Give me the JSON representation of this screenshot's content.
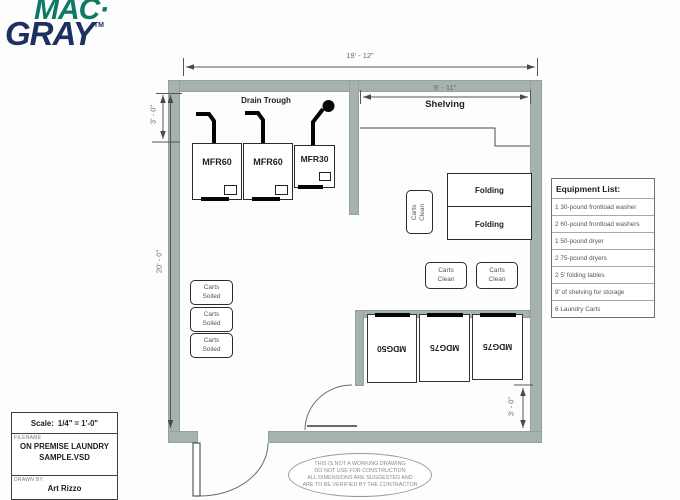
{
  "logo": {
    "mac": "MAC·",
    "gray": "GRAY",
    "trademark": "TM"
  },
  "dimensions": {
    "top_width": "19' - 12\"",
    "shelving_width": "9' - 11\"",
    "trough_depth": "3' - 0\"",
    "room_depth": "20' - 0\"",
    "dryer_clearance": "3' - 0\""
  },
  "plan": {
    "drain_trough_label": "Drain Trough",
    "shelving_label": "Shelving",
    "washers": [
      "MFR60",
      "MFR60",
      "MFR30"
    ],
    "dryers": [
      "MDG50",
      "MDG75",
      "MDG75"
    ],
    "folding_tables": [
      "Folding",
      "Folding"
    ],
    "carts_clean": {
      "line1": "Carts",
      "line2": "Clean"
    },
    "carts_soiled": {
      "line1": "Carts",
      "line2": "Soiled"
    }
  },
  "equipment_list": {
    "title": "Equipment List:",
    "items": [
      "1 30-pound frontload washer",
      "2 60-pound frontload washers",
      "1 50-pound dryer",
      "2 75-pound dryers",
      "2 5' folding tables",
      "9' of shelving for storage",
      "6 Laundry Carts"
    ]
  },
  "title_block": {
    "scale_label": "Scale:",
    "scale_value": "1/4\" = 1'-0\"",
    "filename_label": "FILENAME",
    "filename_line1": "ON PREMISE LAUNDRY",
    "filename_line2": "SAMPLE.VSD",
    "drawn_by_label": "DRAWN BY",
    "drawn_by": "Art Rizzo"
  },
  "disclaimer": {
    "line1": "THIS IS NOT A WORKING DRAWING",
    "line2": "DO NOT USE FOR CONSTRUCTION",
    "line3": "ALL DIMENSIONS ARE SUGGESTED AND",
    "line4": "ARE TO BE VERIFIED BY THE CONTRACTOR"
  },
  "colors": {
    "wall": "#a6b3ad",
    "logo_green": "#0e7a66",
    "logo_navy": "#1e3062",
    "line": "#555555"
  }
}
